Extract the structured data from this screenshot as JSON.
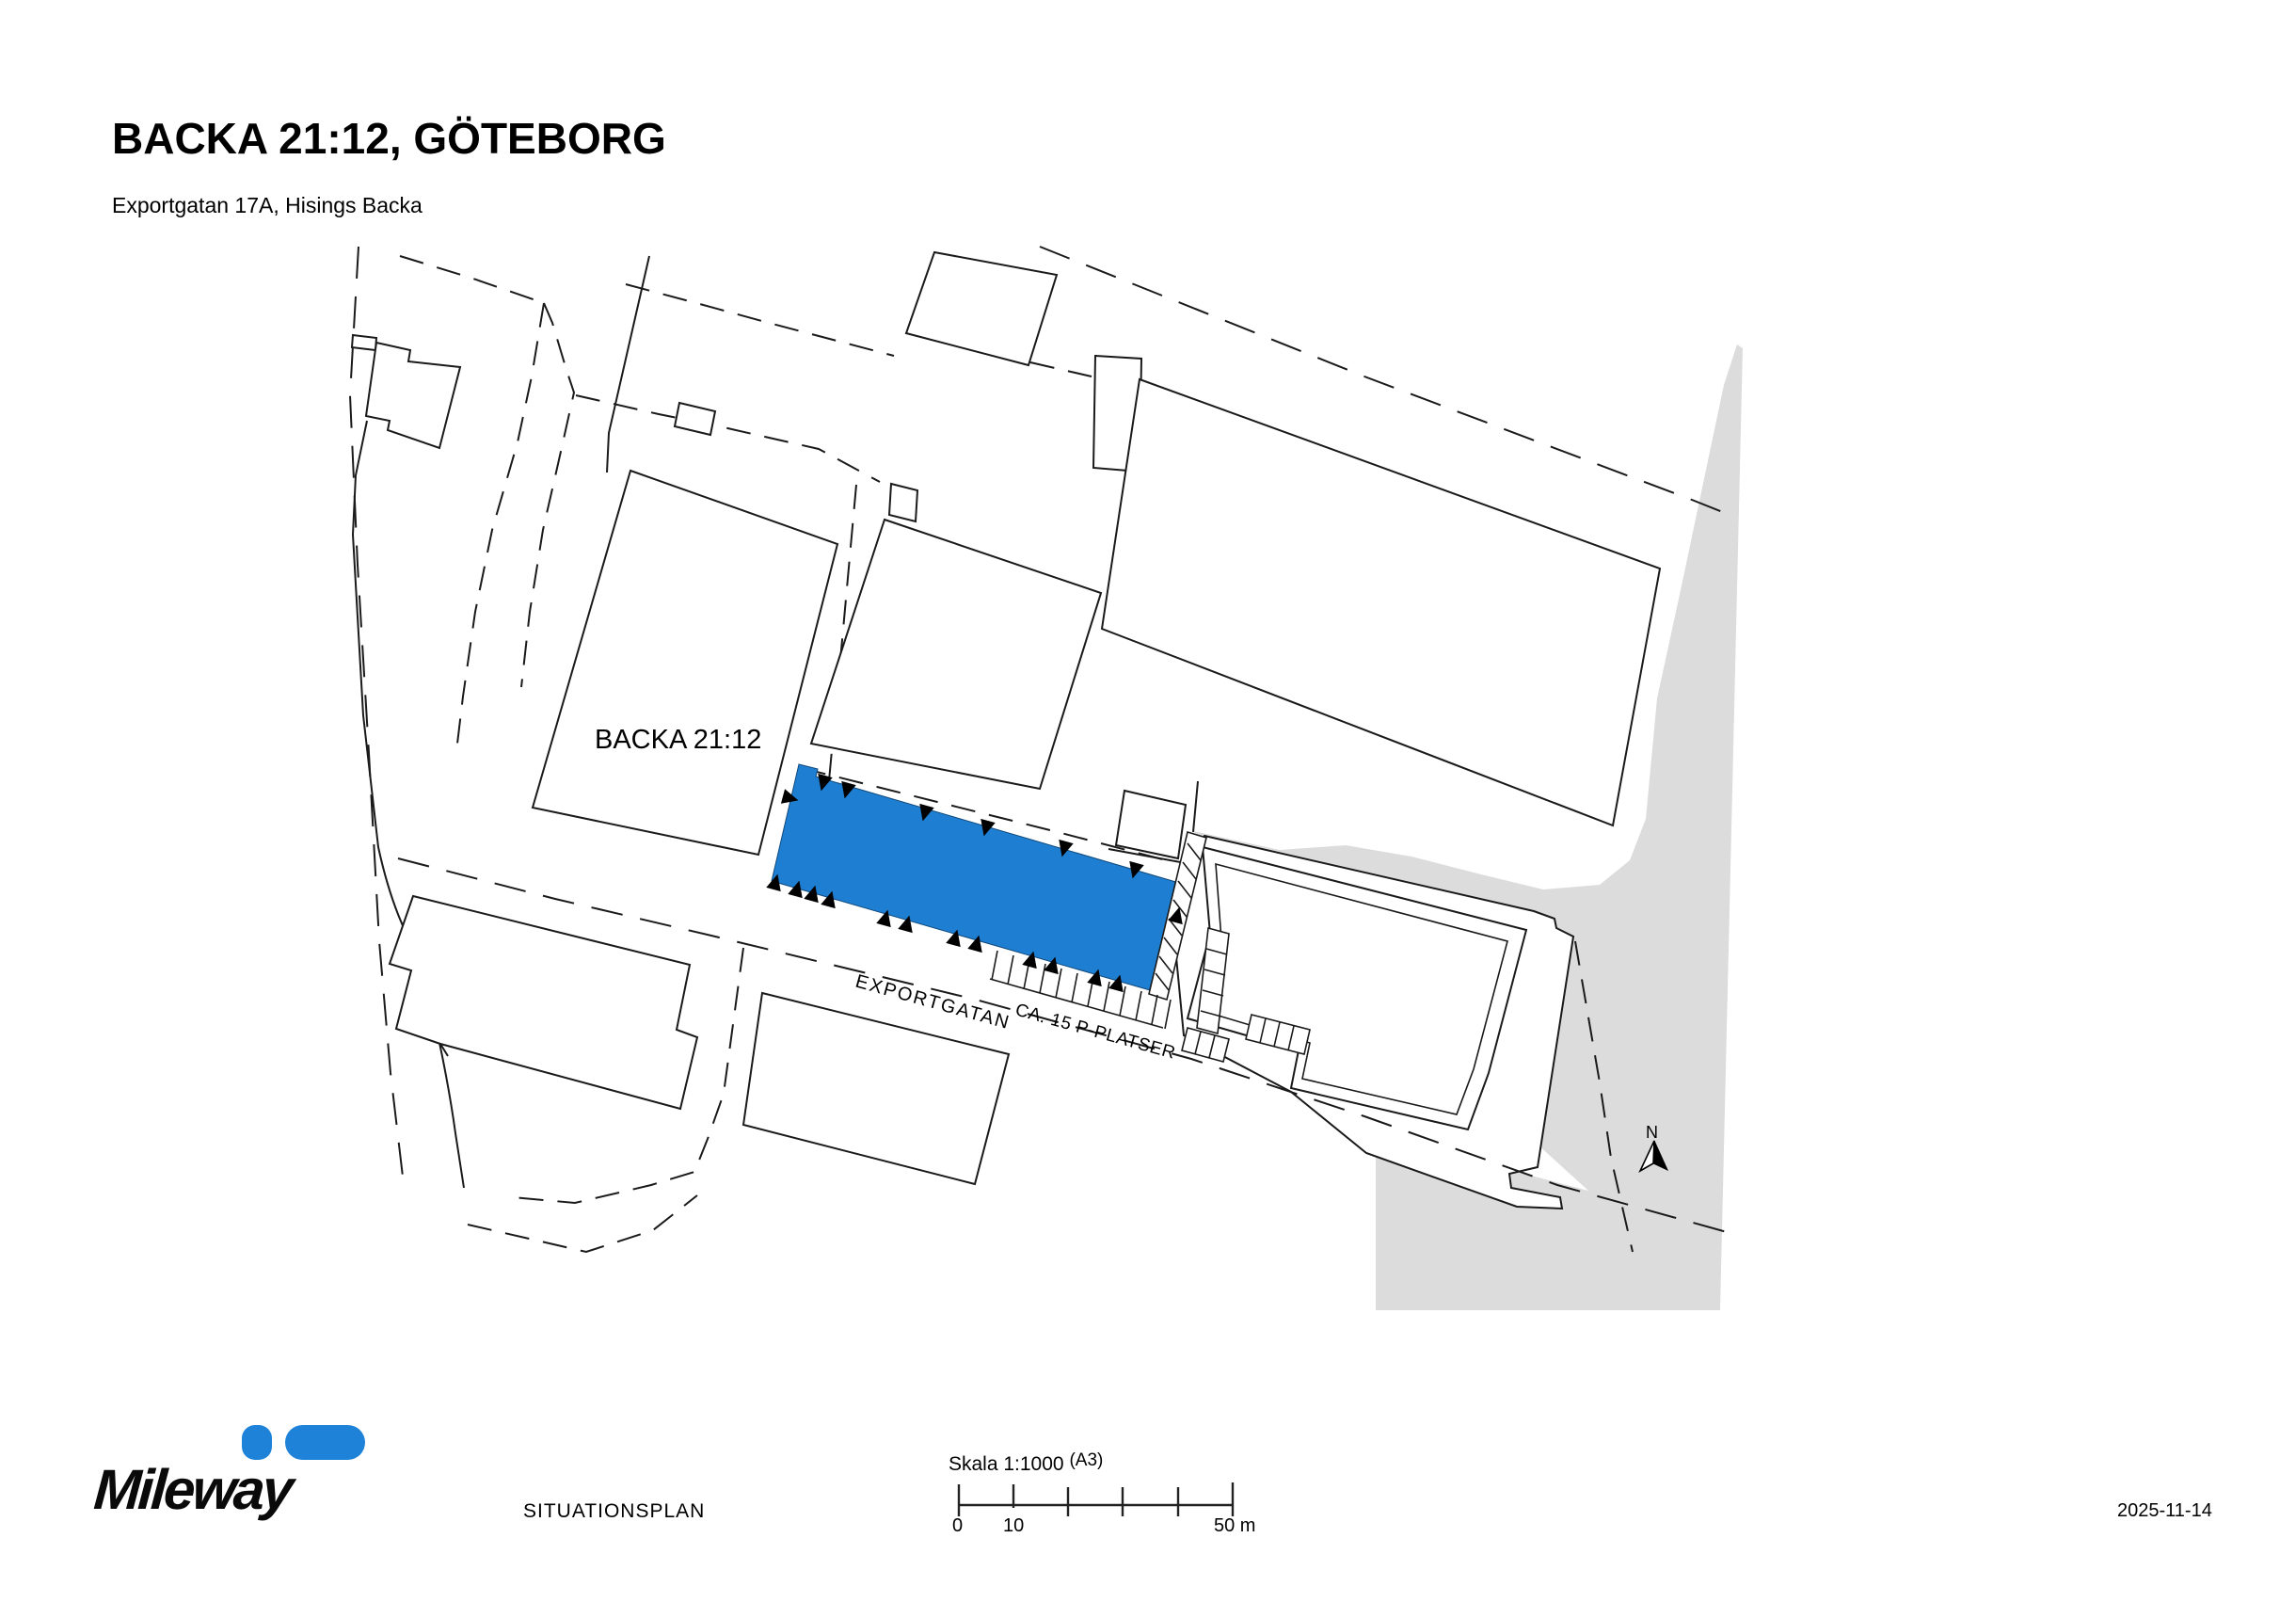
{
  "page": {
    "title": "BACKA 21:12, GÖTEBORG",
    "subtitle": "Exportgatan 17A, Hisings Backa",
    "doc_type_label": "SITUATIONSPLAN",
    "date": "2025-11-14"
  },
  "map": {
    "parcel_label": "BACKA 21:12",
    "street_label": "EXPORTGATAN",
    "parking_label": "CA. 15 P-PLATSER",
    "north_label": "N",
    "highlight_color": "#1e7fd2",
    "ground_color": "#dcdcdc",
    "line_color": "#1a1a1a"
  },
  "scalebar": {
    "label": "Skala 1:1000",
    "paper_size": "(A3)",
    "tick_0": "0",
    "tick_10": "10",
    "tick_50": "50 m"
  },
  "logo": {
    "wordmark": "Mileway",
    "brand_color": "#1e82d9"
  }
}
